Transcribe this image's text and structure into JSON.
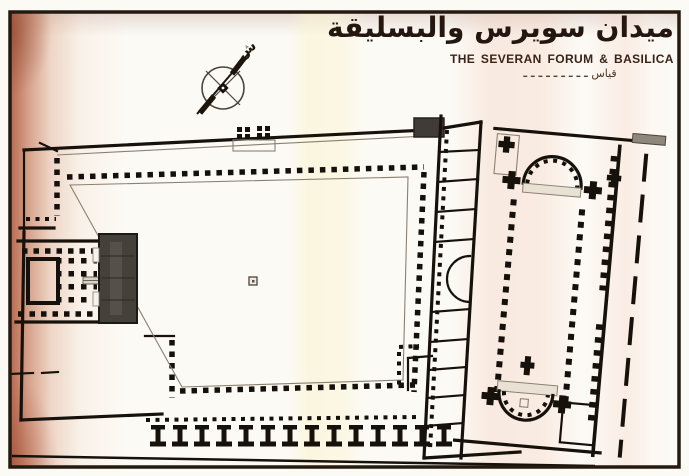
{
  "title": {
    "arabic": "ميدان سويرس والبسليقة",
    "english": "THE SEVERAN FORUM & BASILICA",
    "scale_word": "قياس",
    "scale_dashes": "ـ ـ ـ ـ ـ ـ ـ ـ ـ"
  },
  "compass": {
    "north_glyph": "ش"
  },
  "colors": {
    "ink": "#17110b",
    "scan_tint": "#b85c3e",
    "stairs_grey": "#44403a",
    "lintel_grey": "#8d877c",
    "paper": "#fcfaf5"
  }
}
